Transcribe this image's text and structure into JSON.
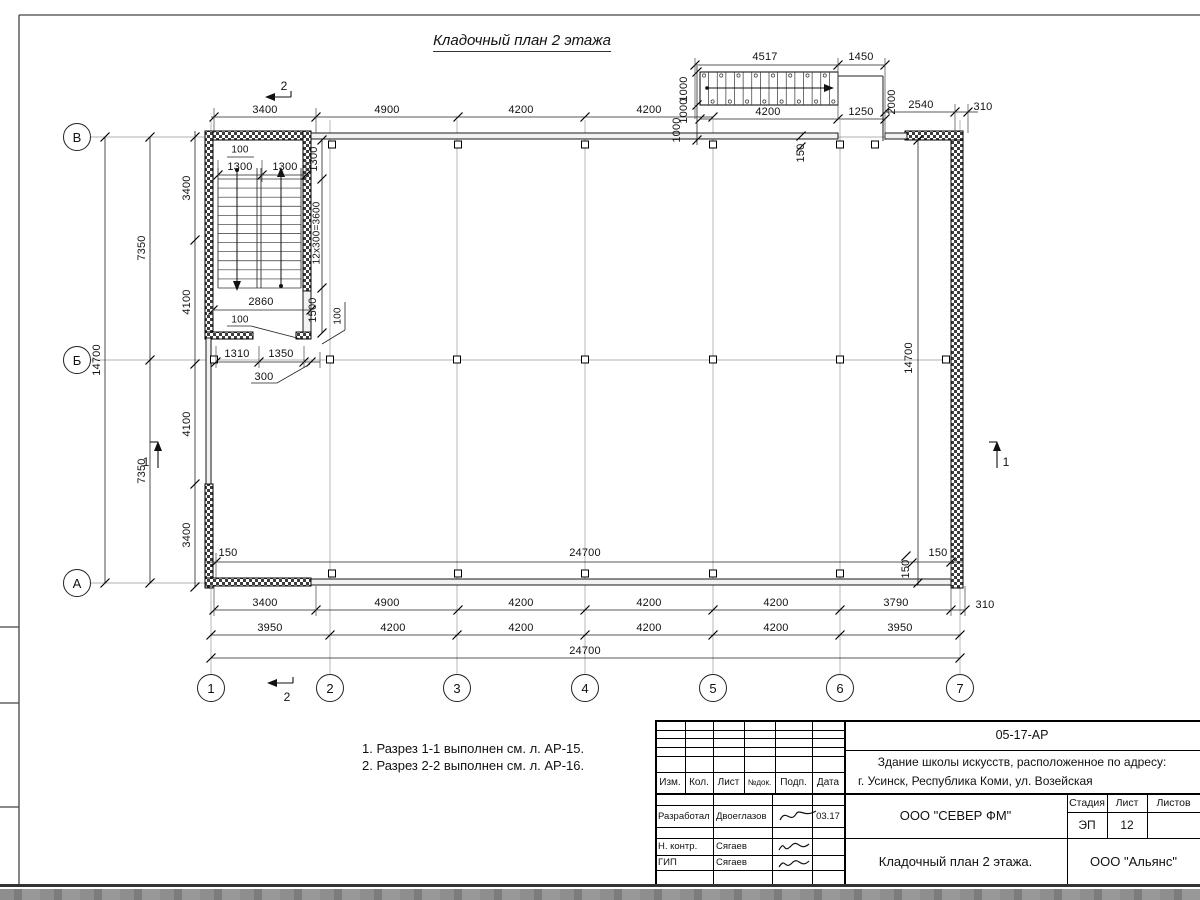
{
  "title": "Кладочный план 2 этажа",
  "notes": [
    "1. Разрез 1-1 выполнен см. л. АР-15.",
    "2. Разрез 2-2 выполнен см. л. АР-16."
  ],
  "axes": {
    "rows": [
      {
        "label": "В",
        "x": 77,
        "y": 137
      },
      {
        "label": "Б",
        "x": 77,
        "y": 360
      },
      {
        "label": "А",
        "x": 77,
        "y": 583
      }
    ],
    "cols": [
      {
        "label": "1",
        "x": 211,
        "y": 688
      },
      {
        "label": "2",
        "x": 330,
        "y": 688
      },
      {
        "label": "3",
        "x": 457,
        "y": 688
      },
      {
        "label": "4",
        "x": 585,
        "y": 688
      },
      {
        "label": "5",
        "x": 713,
        "y": 688
      },
      {
        "label": "6",
        "x": 840,
        "y": 688
      },
      {
        "label": "7",
        "x": 960,
        "y": 688
      }
    ]
  },
  "dim_labels": [
    {
      "t": "3400",
      "x": 265,
      "y": 110
    },
    {
      "t": "4900",
      "x": 387,
      "y": 110
    },
    {
      "t": "4200",
      "x": 521,
      "y": 110
    },
    {
      "t": "4200",
      "x": 649,
      "y": 110
    },
    {
      "t": "4517",
      "x": 765,
      "y": 57
    },
    {
      "t": "1450",
      "x": 861,
      "y": 57
    },
    {
      "t": "4200",
      "x": 768,
      "y": 112
    },
    {
      "t": "1250",
      "x": 861,
      "y": 112
    },
    {
      "t": "2540",
      "x": 921,
      "y": 105
    },
    {
      "t": "310",
      "x": 983,
      "y": 107
    },
    {
      "t": "1000",
      "x": 684,
      "y": 89,
      "r": -90
    },
    {
      "t": "1000",
      "x": 684,
      "y": 111,
      "r": -90
    },
    {
      "t": "1000",
      "x": 677,
      "y": 130,
      "r": -90
    },
    {
      "t": "2000",
      "x": 892,
      "y": 102,
      "r": -90
    },
    {
      "t": "150",
      "x": 801,
      "y": 153,
      "r": -90
    },
    {
      "t": "14700",
      "x": 97,
      "y": 360,
      "r": -90
    },
    {
      "t": "7350",
      "x": 142,
      "y": 248,
      "r": -90
    },
    {
      "t": "7350",
      "x": 142,
      "y": 471,
      "r": -90
    },
    {
      "t": "3400",
      "x": 187,
      "y": 188,
      "r": -90
    },
    {
      "t": "4100",
      "x": 187,
      "y": 302,
      "r": -90
    },
    {
      "t": "4100",
      "x": 187,
      "y": 424,
      "r": -90
    },
    {
      "t": "3400",
      "x": 187,
      "y": 535,
      "r": -90
    },
    {
      "t": "100",
      "x": 240,
      "y": 150,
      "fs": 10
    },
    {
      "t": "1300",
      "x": 240,
      "y": 167
    },
    {
      "t": "1300",
      "x": 285,
      "y": 167
    },
    {
      "t": "1300",
      "x": 314,
      "y": 159,
      "r": -90
    },
    {
      "t": "12x300=3600",
      "x": 317,
      "y": 233,
      "r": -90,
      "fs": 10
    },
    {
      "t": "2860",
      "x": 261,
      "y": 302
    },
    {
      "t": "100",
      "x": 240,
      "y": 320,
      "fs": 10
    },
    {
      "t": "1500",
      "x": 313,
      "y": 310,
      "r": -90
    },
    {
      "t": "100",
      "x": 338,
      "y": 316,
      "r": -90,
      "fs": 10
    },
    {
      "t": "1310",
      "x": 237,
      "y": 354
    },
    {
      "t": "1350",
      "x": 281,
      "y": 354
    },
    {
      "t": "300",
      "x": 264,
      "y": 377
    },
    {
      "t": "14700",
      "x": 909,
      "y": 358,
      "r": -90
    },
    {
      "t": "150",
      "x": 938,
      "y": 553
    },
    {
      "t": "150",
      "x": 906,
      "y": 569,
      "r": -90
    },
    {
      "t": "150",
      "x": 228,
      "y": 553
    },
    {
      "t": "24700",
      "x": 585,
      "y": 553
    },
    {
      "t": "3400",
      "x": 265,
      "y": 603
    },
    {
      "t": "4900",
      "x": 387,
      "y": 603
    },
    {
      "t": "4200",
      "x": 521,
      "y": 603
    },
    {
      "t": "4200",
      "x": 649,
      "y": 603
    },
    {
      "t": "4200",
      "x": 776,
      "y": 603
    },
    {
      "t": "3790",
      "x": 896,
      "y": 603
    },
    {
      "t": "310",
      "x": 985,
      "y": 605
    },
    {
      "t": "3950",
      "x": 270,
      "y": 628
    },
    {
      "t": "4200",
      "x": 393,
      "y": 628
    },
    {
      "t": "4200",
      "x": 521,
      "y": 628
    },
    {
      "t": "4200",
      "x": 649,
      "y": 628
    },
    {
      "t": "4200",
      "x": 776,
      "y": 628
    },
    {
      "t": "3950",
      "x": 900,
      "y": 628
    },
    {
      "t": "24700",
      "x": 585,
      "y": 651
    },
    {
      "t": "2",
      "x": 284,
      "y": 86,
      "fs": 12
    },
    {
      "t": "2",
      "x": 287,
      "y": 697,
      "fs": 12
    },
    {
      "t": "1",
      "x": 146,
      "y": 462,
      "fs": 12
    },
    {
      "t": "1",
      "x": 1006,
      "y": 462,
      "fs": 12
    }
  ],
  "titleblock": {
    "doc_code": "05-17-АР",
    "project_line1": "Здание школы искусств, расположенное по адресу:",
    "project_line2": "г. Усинск, Республика Коми, ул. Возейская",
    "col_izm": "Изм.",
    "col_kol": "Кол.",
    "col_list": "Лист",
    "col_ndok": "№док.",
    "col_podp": "Подп.",
    "col_data": "Дата",
    "rows": [
      {
        "role": "Разработал",
        "name": "Двоеглазов",
        "date": "03.17"
      },
      {
        "role": "Н. контр.",
        "name": "Сягаев",
        "date": ""
      },
      {
        "role": "ГИП",
        "name": "Сягаев",
        "date": ""
      }
    ],
    "org": "ООО \"СЕВЕР ФМ\"",
    "sheet_title": "Кладочный план 2 этажа.",
    "stage_label": "Стадия",
    "sheet_label": "Лист",
    "sheets_label": "Листов",
    "stage": "ЭП",
    "sheet_num": "12",
    "sheets_total": "",
    "contractor": "ООО \"Альянс\""
  }
}
